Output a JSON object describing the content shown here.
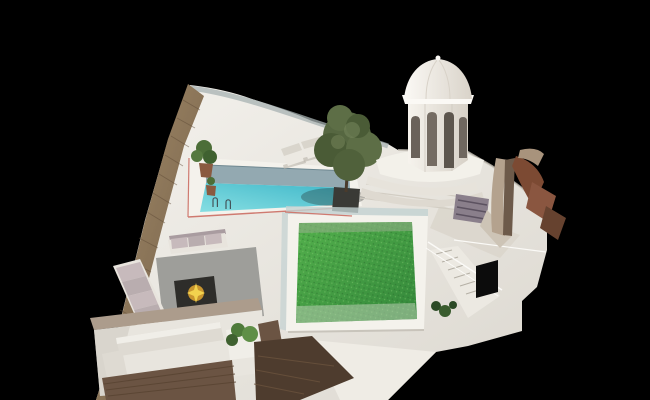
{
  "scene": {
    "description": "3D architectural rendering of a rooftop terrace model on a black background, featuring a turquoise swimming pool, green roof lawn with glass balustrade, white domed cupola tower, rusted steel sculpture, outdoor lounge with fire pit, sunken seating terrace and timber decking",
    "width_px": 650,
    "height_px": 400,
    "sun_loungers_count": 2,
    "pool_ladders_count": 2
  },
  "objects": [
    {
      "name": "rooftop-terrace",
      "label": "white rooftop terrace platform"
    },
    {
      "name": "swimming-pool",
      "label": "turquoise swimming pool with white coping and red trim line"
    },
    {
      "name": "pool-step-shelf",
      "label": "grey submerged shelf along pool top edge"
    },
    {
      "name": "pool-ladders",
      "label": "two chrome pool ladders"
    },
    {
      "name": "sun-loungers",
      "label": "two white sun loungers"
    },
    {
      "name": "perimeter-glass-railing",
      "label": "curved glass railing along top terrace edge"
    },
    {
      "name": "wooden-fence",
      "label": "tall timber fence along the left edge"
    },
    {
      "name": "potted-plants",
      "label": "terracotta potted plants at pool corner"
    },
    {
      "name": "tree-in-planter",
      "label": "large tree in dark planter beside pool"
    },
    {
      "name": "green-roof-lawn",
      "label": "bright green lawn roof with white frame and glass balustrade"
    },
    {
      "name": "staircase",
      "label": "white staircase with thin railings"
    },
    {
      "name": "doorway",
      "label": "dark doorway at stair base"
    },
    {
      "name": "domed-tower",
      "label": "white octagonal cupola tower with arched openings and dome"
    },
    {
      "name": "rust-sculpture",
      "label": "curled rusted-steel sculpture"
    },
    {
      "name": "purple-bench",
      "label": "striped mauve bench near tower"
    },
    {
      "name": "lounge-sofas",
      "label": "L-shaped sofa with mauve cushions"
    },
    {
      "name": "fire-pit",
      "label": "dark fire pit table with yellow flame"
    },
    {
      "name": "sunken-terrace",
      "label": "lower sunken terrace with white benches and shrub planter"
    },
    {
      "name": "timber-decking",
      "label": "dark timber deck areas at bottom"
    }
  ],
  "colors": {
    "background": "#000000",
    "terraceLight": "#f4f2ed",
    "terraceDark": "#dcd8d0",
    "terraceEdge": "#c6c0b6",
    "copingWhite": "#f4f2ec",
    "redTrim": "#cf7a70",
    "poolShelf": "#93a9b1",
    "poolShallow": "#86dee2",
    "poolDeep": "#3db6c8",
    "poolEdgeLine": "#6f8891",
    "ladderMetal": "#44545a",
    "railingGlass": "#a7b2b2",
    "woodLight": "#a8906d",
    "woodDark": "#6e5a44",
    "woodPlankLine": "#5e4a36",
    "grassLight": "#53b04c",
    "grassDark": "#33873a",
    "grassDotDark": "#2c6e2e",
    "grassDotLight": "#7cc46c",
    "grassTopStrip": "#8fae85",
    "grassBottomStrip": "#b9cdb2",
    "glassPanel": "#c3d2d2",
    "frameShadow": "#b7b2a8",
    "stairSlab": "#ece9e2",
    "stairStepLine": "#b5b0a6",
    "stairRail": "#fbfaf7",
    "doorwayDark": "#0c0c0c",
    "stepLine": "#d2cdc3",
    "towerLight": "#f6f3ed",
    "towerShade": "#d7d1c7",
    "towerEdgeLine": "#cfc9bf",
    "domeLight": "#fbf9f5",
    "domeShade": "#d9d3c9",
    "domeRidge": "#d8d2c8",
    "archDark1": "#6a625a",
    "archDark2": "#756c63",
    "archDark3": "#5d564e",
    "archDark4": "#6f675f",
    "platformWhite": "#f3f1ea",
    "platformStep1": "#e7e3db",
    "platformStep2": "#ded9d0",
    "benchMauve": "#8a7f8b",
    "benchStripe": "#5c5260",
    "rustTan": "#b4a28e",
    "rustFold": "#6d5a4a",
    "rustDark": "#7c4a33",
    "rustMid": "#8a5640",
    "rustDeep": "#66422f",
    "rustCurl": "#a8937c",
    "rustBase": "#cdc4b6",
    "treeCanopy1": "#566741",
    "treeCanopy2": "#4a5b36",
    "treeCanopy3": "#5d6e46",
    "treeCanopy4": "#50613b",
    "treeHighlight": "#77875c",
    "treeTrunk": "#4a3b2c",
    "planterDark": "#3a3a36",
    "plantGreen1": "#4c6e38",
    "plantGreen2": "#55793f",
    "plantGreen3": "#3f6130",
    "terracottaPot": "#8a5a40",
    "loungerWhite": "#ece9e2",
    "loungerBack": "#d9d5cc",
    "loungerShadow": "#b9b4aa",
    "concreteFloor": "#9e9e9a",
    "sofaBase": "#e8e4dd",
    "sofaCushionLight": "#c7babc",
    "sofaCushionDark": "#b9adaf",
    "sofaBack": "#a99ca0",
    "firePitDark": "#2e2d2a",
    "fireGlow": "#c8952f",
    "fireSpark": "#f2d24e",
    "wallBandTan": "#ac9c8c",
    "sunkenFloor": "#e8e5de",
    "sunkenShadow": "#cfcac1",
    "benchWhite": "#dedad2",
    "benchTop": "#f0eee8",
    "deckDark": "#6b5443",
    "deckPlank": "#584331",
    "deckDarker": "#4e3c2e",
    "deckPlank2": "#6b533d",
    "shrubGreen1": "#4e7a3a",
    "shrubGreen2": "#5f8f47",
    "stairPlant1": "#2c4a26",
    "stairPlant2": "#3a5c2e",
    "walkwayGrey": "#d9d4cb",
    "brightWall": "#efece5",
    "shadowSoft": "#1a1a18"
  }
}
